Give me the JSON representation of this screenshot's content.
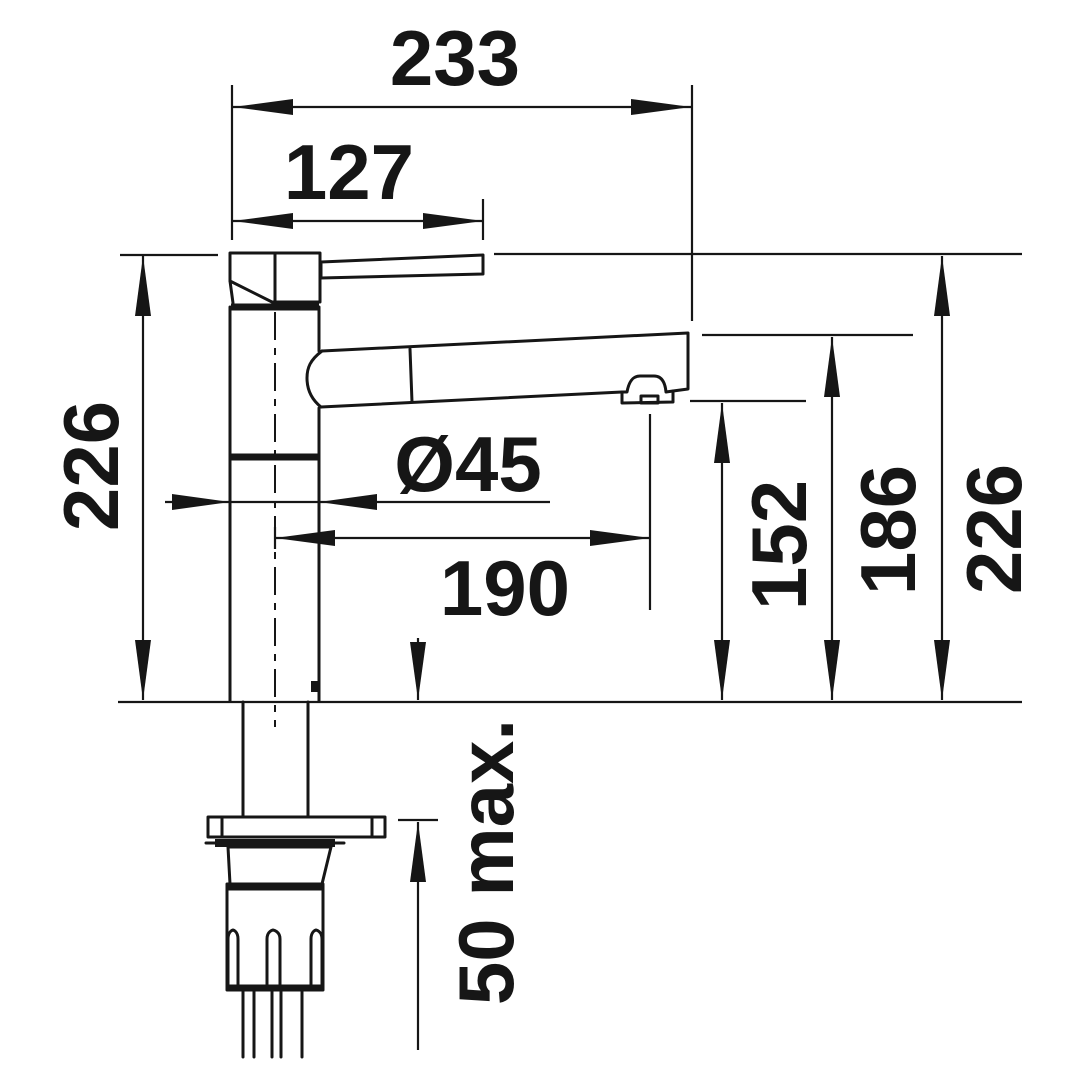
{
  "drawing": {
    "type": "technical-dimension-drawing",
    "subject": "single-lever kitchen faucet with pull-out spray, side view",
    "unit": "mm",
    "colors": {
      "line": "#161616",
      "background": "#ffffff"
    },
    "labels": {
      "overall_width": "233",
      "handle_width": "127",
      "total_height_left": "226",
      "base_diameter": "Ø45",
      "spout_reach": "190",
      "outlet_height": "152",
      "spout_height": "186",
      "total_height_right": "226",
      "countertop_max": "50 max."
    }
  }
}
